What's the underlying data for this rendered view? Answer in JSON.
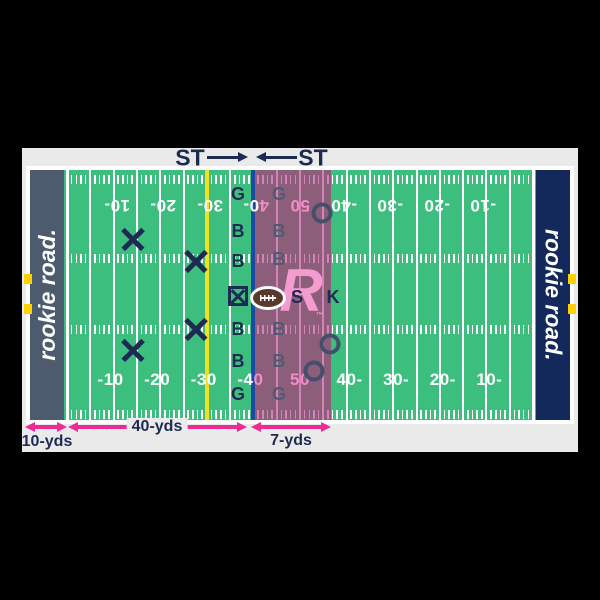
{
  "header": {
    "team_left_label": "ST",
    "team_right_label": "ST"
  },
  "field": {
    "endzone_left_text": "rookie road.",
    "endzone_right_text": "rookie road.",
    "colors": {
      "green": "#3cbe7e",
      "endzone_left": "#4d5b6e",
      "endzone_right": "#13295b",
      "yellow_line": "#f2e120",
      "blue_line": "#1b4aa2",
      "highlight_zone": "#8c5e79",
      "pink_line": "#d184b5",
      "pink_number": "#f18cc6",
      "white": "#ffffff",
      "navy": "#1d2b52",
      "dim_navy": "#4f5b74",
      "arrow_pink": "#ee2b93",
      "football_brown": "#5a392c",
      "logo_pink": "#f49bd0",
      "sideline_marker": "#ffd105"
    },
    "numbers_bottom": [
      {
        "x": 113.6,
        "parts": [
          {
            "t": "-10",
            "c": "w"
          }
        ]
      },
      {
        "x": 160.2,
        "parts": [
          {
            "t": "-20",
            "c": "w"
          }
        ]
      },
      {
        "x": 206.8,
        "parts": [
          {
            "t": "-30",
            "c": "w"
          }
        ]
      },
      {
        "x": 253.4,
        "parts": [
          {
            "t": "-4",
            "c": "w"
          },
          {
            "t": "0",
            "c": "p"
          }
        ]
      },
      {
        "x": 300.0,
        "parts": [
          {
            "t": "50",
            "c": "p"
          }
        ]
      },
      {
        "x": 346.6,
        "parts": [
          {
            "t": "40-",
            "c": "w"
          }
        ]
      },
      {
        "x": 393.2,
        "parts": [
          {
            "t": "30-",
            "c": "w"
          }
        ]
      },
      {
        "x": 439.8,
        "parts": [
          {
            "t": "20-",
            "c": "w"
          }
        ]
      },
      {
        "x": 486.4,
        "parts": [
          {
            "t": "10-",
            "c": "w"
          }
        ]
      }
    ],
    "numbers_top": [
      {
        "x": 113.6,
        "parts": [
          {
            "t": "10-",
            "c": "w"
          }
        ]
      },
      {
        "x": 160.2,
        "parts": [
          {
            "t": "20-",
            "c": "w"
          }
        ]
      },
      {
        "x": 206.8,
        "parts": [
          {
            "t": "30-",
            "c": "w"
          }
        ]
      },
      {
        "x": 253.4,
        "parts": [
          {
            "t": "4",
            "c": "p"
          },
          {
            "t": "0-",
            "c": "w"
          }
        ]
      },
      {
        "x": 300.0,
        "parts": [
          {
            "t": "50",
            "c": "p"
          }
        ]
      },
      {
        "x": 346.6,
        "parts": [
          {
            "t": "-40",
            "c": "w"
          }
        ]
      },
      {
        "x": 393.2,
        "parts": [
          {
            "t": "-30",
            "c": "w"
          }
        ]
      },
      {
        "x": 439.8,
        "parts": [
          {
            "t": "-20",
            "c": "w"
          }
        ]
      },
      {
        "x": 486.4,
        "parts": [
          {
            "t": "-10",
            "c": "w"
          }
        ]
      }
    ]
  },
  "players": {
    "x_marks": [
      {
        "x": 133,
        "y": 239
      },
      {
        "x": 196,
        "y": 261
      },
      {
        "x": 196,
        "y": 329
      },
      {
        "x": 133,
        "y": 350
      }
    ],
    "o_marks": [
      {
        "x": 322,
        "y": 213
      },
      {
        "x": 330,
        "y": 344
      },
      {
        "x": 314,
        "y": 371
      }
    ],
    "left_line": {
      "x": 238,
      "items": [
        {
          "y": 194,
          "t": "G"
        },
        {
          "y": 231,
          "t": "B"
        },
        {
          "y": 261,
          "t": "B"
        },
        {
          "y": 296,
          "t": "",
          "type": "snapper"
        },
        {
          "y": 329,
          "t": "B"
        },
        {
          "y": 361,
          "t": "B"
        },
        {
          "y": 394,
          "t": "G"
        }
      ]
    },
    "right_line": {
      "x": 279,
      "items": [
        {
          "y": 194,
          "t": "G"
        },
        {
          "y": 231,
          "t": "B"
        },
        {
          "y": 259,
          "t": "B"
        },
        {
          "y": 329,
          "t": "B"
        },
        {
          "y": 361,
          "t": "B"
        },
        {
          "y": 394,
          "t": "G"
        }
      ]
    },
    "snapper_back_label": "S",
    "kicker_label": "K"
  },
  "logo": {
    "r_text": "R",
    "tm": "™"
  },
  "measurements": {
    "endzone_depth_label": "10-yds",
    "field_span_label": "40-yds",
    "kick_depth_label": "7-yds"
  }
}
